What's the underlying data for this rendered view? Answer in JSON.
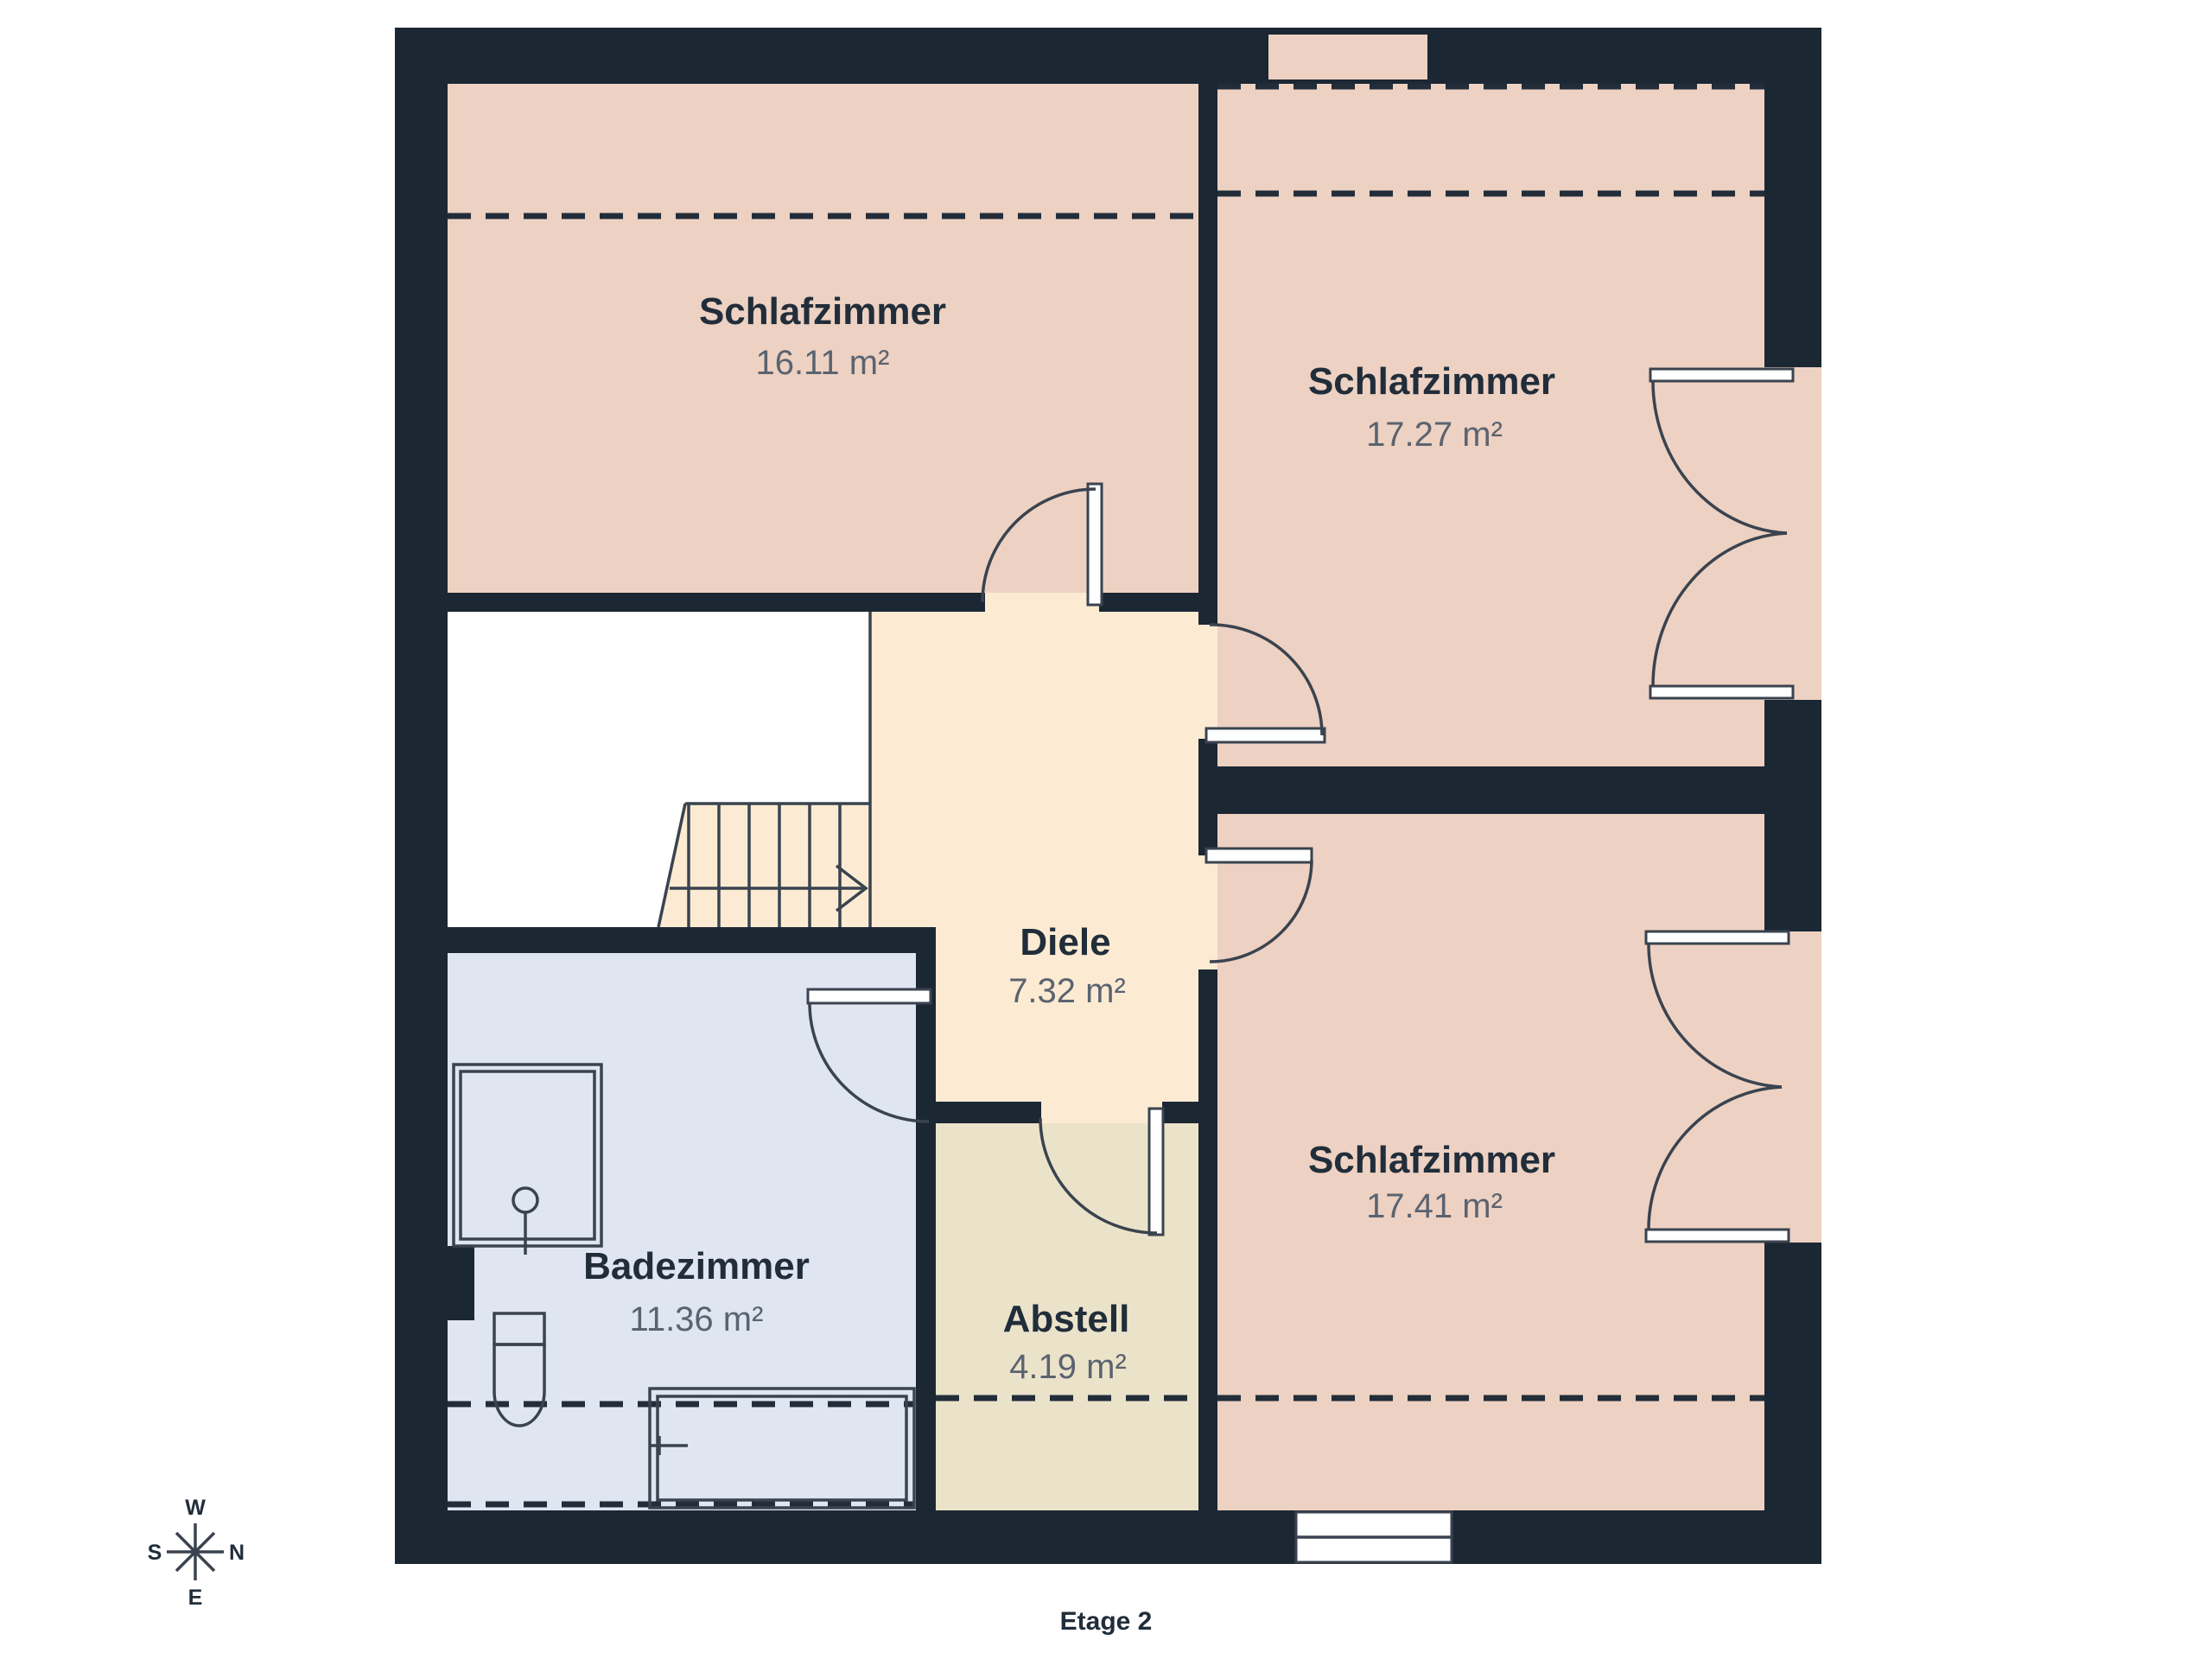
{
  "floor": {
    "label": "Etage 2"
  },
  "rooms": {
    "bedroom_top_left": {
      "name": "Schlafzimmer",
      "area": "16.11 m²"
    },
    "bedroom_top_right": {
      "name": "Schlafzimmer",
      "area": "17.27 m²"
    },
    "hallway": {
      "name": "Diele",
      "area": "7.32 m²"
    },
    "bathroom": {
      "name": "Badezimmer",
      "area": "11.36 m²"
    },
    "storage": {
      "name": "Abstell",
      "area": "4.19 m²"
    },
    "bedroom_bottom_right": {
      "name": "Schlafzimmer",
      "area": "17.41 m²"
    }
  },
  "compass": {
    "top": "W",
    "right": "N",
    "bottom": "E",
    "left": "S"
  },
  "fixtures": [
    "shower",
    "toilet",
    "bathtub",
    "stairs",
    "window",
    "doors"
  ],
  "colors": {
    "wall": "#1c2734",
    "bedroom_fill": "#edd1c2",
    "hallway_fill": "#fcebd2",
    "bathroom_fill": "#e0e6f1",
    "storage_fill": "#ebe3c9",
    "void_fill": "#ffffff",
    "line": "#3a434f",
    "dash": "#222d39",
    "room_name_text": "#212d3a",
    "area_text": "#5a6370"
  }
}
